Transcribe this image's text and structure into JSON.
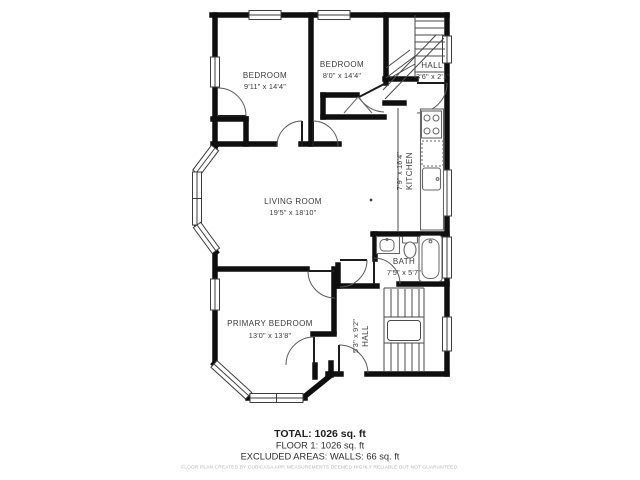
{
  "floor_plan": {
    "rooms": [
      {
        "id": "bedroom-1",
        "name": "BEDROOM",
        "dims": "9'11\" x 14'4\""
      },
      {
        "id": "bedroom-2",
        "name": "BEDROOM",
        "dims": "8'0\" x 14'4\""
      },
      {
        "id": "hall-upper",
        "name": "HALL",
        "dims": "3'6\" x 2'1\""
      },
      {
        "id": "kitchen",
        "name": "KITCHEN",
        "dims": "7'9\" x 16'4\""
      },
      {
        "id": "living-room",
        "name": "LIVING ROOM",
        "dims": "19'5\" x 18'10\""
      },
      {
        "id": "bath",
        "name": "BATH",
        "dims": "7'5\" x 5'7\""
      },
      {
        "id": "primary-bedroom",
        "name": "PRIMARY BEDROOM",
        "dims": "13'0\" x 13'8\""
      },
      {
        "id": "hall-lower",
        "name": "HALL",
        "dims": "5'3\" x 9'2\""
      }
    ],
    "summary": {
      "total": "TOTAL: 1026 sq. ft",
      "floor": "FLOOR 1: 1026 sq. ft",
      "excluded": "EXCLUDED AREAS: WALLS: 66 sq. ft"
    },
    "disclaimer": "FLOOR PLAN CREATED BY CUBICASA APP. MEASUREMENTS DEEMED HIGHLY RELIABLE BUT NOT GUARANTEED.",
    "colors": {
      "wall": "#0f0f0f",
      "line": "#4a4a4a",
      "fixture": "#666666",
      "label": "#3a3a3a",
      "muted": "#b3b3b3",
      "bg": "#ffffff"
    }
  }
}
